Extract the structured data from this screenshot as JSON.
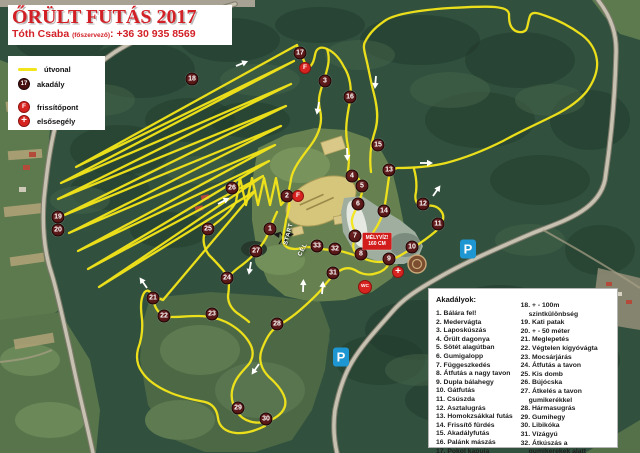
{
  "title": {
    "event": "ŐRÜLT FUTÁS 2017",
    "organizer_name": "Tóth Csaba",
    "organizer_role": "(főszervező)",
    "separator": ":",
    "phone": "+36 30 935 8569"
  },
  "legend": {
    "items": [
      {
        "label": "útvonal",
        "icon": "route-line"
      },
      {
        "label": "akadály",
        "icon": "obstacle-marker",
        "sample": "17"
      },
      {
        "label": "frissítőpont",
        "icon": "refresh-point"
      },
      {
        "label": "elsősegély",
        "icon": "first-aid-cross"
      }
    ]
  },
  "map": {
    "obstacle_markers": [
      {
        "n": 1,
        "x": 270,
        "y": 229
      },
      {
        "n": 2,
        "x": 287,
        "y": 196
      },
      {
        "n": 3,
        "x": 325,
        "y": 81
      },
      {
        "n": 4,
        "x": 352,
        "y": 176
      },
      {
        "n": 5,
        "x": 362,
        "y": 186
      },
      {
        "n": 6,
        "x": 358,
        "y": 204
      },
      {
        "n": 7,
        "x": 355,
        "y": 236
      },
      {
        "n": 8,
        "x": 361,
        "y": 254
      },
      {
        "n": 9,
        "x": 389,
        "y": 259
      },
      {
        "n": 10,
        "x": 412,
        "y": 247
      },
      {
        "n": 11,
        "x": 438,
        "y": 224
      },
      {
        "n": 12,
        "x": 423,
        "y": 204
      },
      {
        "n": 13,
        "x": 389,
        "y": 170
      },
      {
        "n": 14,
        "x": 384,
        "y": 211
      },
      {
        "n": 15,
        "x": 378,
        "y": 145
      },
      {
        "n": 16,
        "x": 350,
        "y": 97
      },
      {
        "n": 17,
        "x": 300,
        "y": 53
      },
      {
        "n": 18,
        "x": 192,
        "y": 79
      },
      {
        "n": 19,
        "x": 58,
        "y": 217
      },
      {
        "n": 20,
        "x": 58,
        "y": 230
      },
      {
        "n": 21,
        "x": 153,
        "y": 298
      },
      {
        "n": 22,
        "x": 164,
        "y": 316
      },
      {
        "n": 23,
        "x": 212,
        "y": 314
      },
      {
        "n": 24,
        "x": 227,
        "y": 278
      },
      {
        "n": 25,
        "x": 208,
        "y": 229
      },
      {
        "n": 26,
        "x": 232,
        "y": 188
      },
      {
        "n": 27,
        "x": 256,
        "y": 251
      },
      {
        "n": 28,
        "x": 277,
        "y": 324
      },
      {
        "n": 29,
        "x": 238,
        "y": 408
      },
      {
        "n": 30,
        "x": 266,
        "y": 419
      },
      {
        "n": 31,
        "x": 333,
        "y": 273
      },
      {
        "n": 32,
        "x": 335,
        "y": 249
      },
      {
        "n": 33,
        "x": 317,
        "y": 246
      }
    ],
    "refresh_glyph": "F",
    "refresh_points": [
      {
        "x": 305,
        "y": 68
      },
      {
        "x": 298,
        "y": 196
      }
    ],
    "first_aid_glyph": "+",
    "first_aid_points": [
      {
        "x": 398,
        "y": 272
      }
    ],
    "wc_label": "WC",
    "wc_points": [
      {
        "x": 365,
        "y": 287
      }
    ],
    "parking_label": "P",
    "parking_points": [
      {
        "x": 468,
        "y": 249
      },
      {
        "x": 341,
        "y": 357
      }
    ],
    "start": {
      "label": "START",
      "x": 286,
      "y": 242,
      "rot": -75
    },
    "finish": {
      "label": "CÉL",
      "x": 300,
      "y": 253,
      "rot": -63
    },
    "warning_sign": {
      "line1": "MÉLYVÍZ!",
      "line2": "160 CM",
      "x": 377,
      "y": 241
    }
  },
  "obstacles": {
    "heading": "Akadályok:",
    "col1": [
      "1. Bálára fel!",
      "2. Medervágta",
      "3. Laposkúszás",
      "4. Őrült dagonya",
      "5. Sötét alagútban",
      "6. Gumigalopp",
      "7. Függeszkedés",
      "8. Átfutás a nagy tavon",
      "9. Dupla bálahegy",
      "10. Gátfutás",
      "11. Csúszda",
      "12. Asztalugrás",
      "13. Homokzsákkal futás",
      "14. Frissítő fürdés",
      "15. Akadályfutás",
      "16. Palánk mászás",
      "17. Pokol kapuja"
    ],
    "col2": [
      "18. + - 100m szintkülönbség",
      "19. Kati patak",
      "20. + - 50 méter",
      "21. Meglepetés",
      "22. Végtelen kígyóvágta",
      "23. Mocsárjárás",
      "24. Átfutás a tavon",
      "25. Kis domb",
      "26. Bújócska",
      "27. Átkelés a tavon gumikerékkel",
      "28. Hármasugrás",
      "29. Gumihegy",
      "30. Libikóka",
      "31. Vízágyú",
      "32. Átkúszás a gumikerekek alatt",
      "33. Gladiators"
    ]
  },
  "colors": {
    "route_yellow": "#f2e41a",
    "marker_maroon": "#4a1111",
    "accent_red": "#d82420",
    "parking_blue": "#1e96d2",
    "title_red": "#d22026",
    "sign_red": "#d31c1c"
  }
}
